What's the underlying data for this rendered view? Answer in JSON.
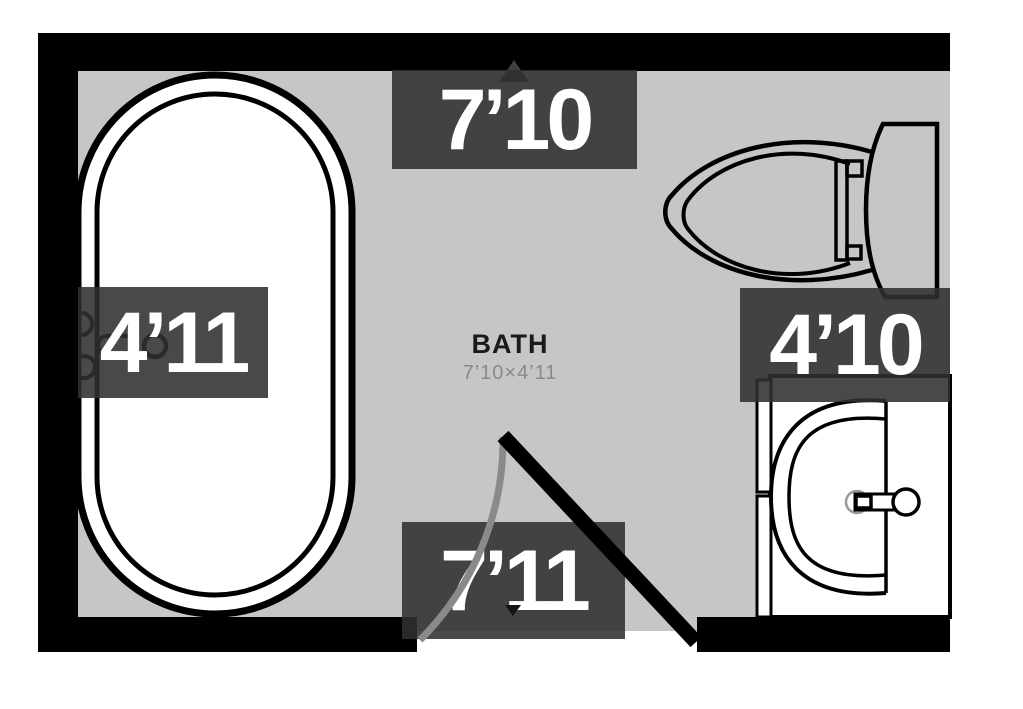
{
  "plan": {
    "room": {
      "name": "BATH",
      "size": "7’10×4’11"
    },
    "dimensions": {
      "top": "7’10",
      "left": "4’11",
      "right": "4’10",
      "bottom": "7’11"
    },
    "fixtures": [
      "bathtub",
      "toilet",
      "sink-vanity",
      "door"
    ],
    "colors": {
      "wall": "#000000",
      "floor": "#c6c6c6",
      "label_bg": "#303030",
      "label_text": "#ffffff",
      "room_name_text": "#1a1a1a",
      "room_size_text": "#8a8a8a",
      "door_arc": "#8a8a8a",
      "fixture_fill": "#ffffff",
      "fixture_stroke": "#000000"
    }
  }
}
